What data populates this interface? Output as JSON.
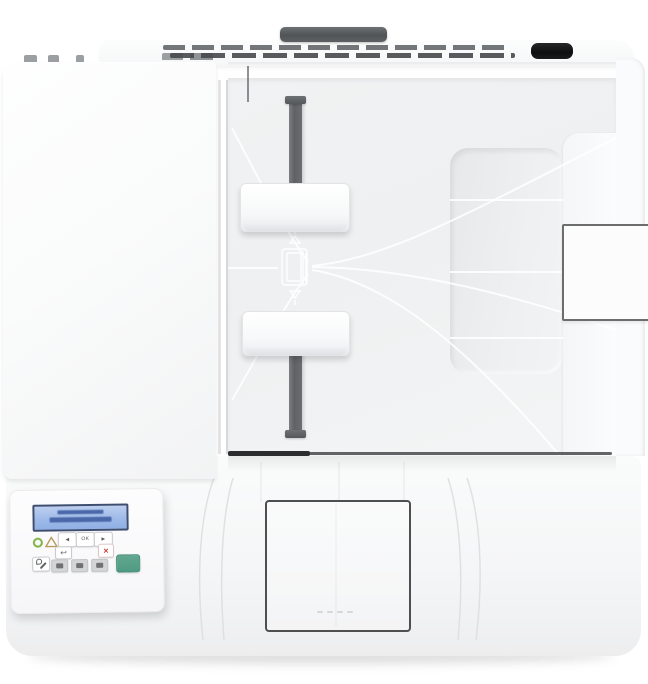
{
  "image": {
    "type": "product-photo",
    "alt": "Top-down view of a white monochrome laser multifunction printer with automatic document feeder and two-line LCD control panel",
    "background_color": "#ffffff"
  },
  "printer": {
    "body_color": "#f7f8f9",
    "parts": {
      "top_handle_bar": {
        "name": "lid handle bar",
        "color": "#5a5d60"
      },
      "vent_grille": {
        "rows": 2,
        "slot_color": "#4b4e51"
      },
      "rear_port": {
        "name": "rear connector recess",
        "color": "#141516"
      },
      "scanner_lid": {
        "name": "flatbed scanner lid",
        "color": "#fbfcfd"
      },
      "adf_tray": {
        "name": "document feeder input tray",
        "color": "#f0f1f2"
      },
      "paper_guide_rail": {
        "name": "adjustable guide rail",
        "color": "#64676a"
      },
      "paper_guides": {
        "count": 2,
        "color": "#ffffff"
      },
      "load_paper_icon": {
        "name": "embossed load-paper glyph"
      },
      "handle_recess": {
        "name": "tray hand recess"
      },
      "output_flag": {
        "name": "side paper-stop flag",
        "border_color": "#6b6d6f"
      },
      "front_door": {
        "name": "front door seam",
        "border_color": "#4d4f51"
      },
      "grip_dots": 4
    }
  },
  "control_panel": {
    "display": {
      "type": "2-line-lcd",
      "screen_color": "#a9c2ec",
      "frame_color": "#3f4e70",
      "text_color": "#4a67a9",
      "line_count": 2
    },
    "indicators": [
      {
        "name": "ready-led",
        "color": "#7db344"
      },
      {
        "name": "attention-led",
        "color": "#b79b5e"
      }
    ],
    "buttons": [
      {
        "name": "left-arrow-button",
        "glyph": "◄"
      },
      {
        "name": "ok-button",
        "glyph": "OK"
      },
      {
        "name": "right-arrow-button",
        "glyph": "►"
      },
      {
        "name": "back-button",
        "glyph": "↩"
      },
      {
        "name": "cancel-button",
        "glyph": "×",
        "glyph_color": "#cf3b35"
      },
      {
        "name": "setup-button",
        "glyph": "wrench"
      },
      {
        "name": "copy-option-button-1",
        "glyph": ""
      },
      {
        "name": "copy-option-button-2",
        "glyph": ""
      },
      {
        "name": "copy-option-button-3",
        "glyph": ""
      },
      {
        "name": "start-copy-button",
        "glyph": "",
        "color": "#539b85"
      }
    ]
  }
}
